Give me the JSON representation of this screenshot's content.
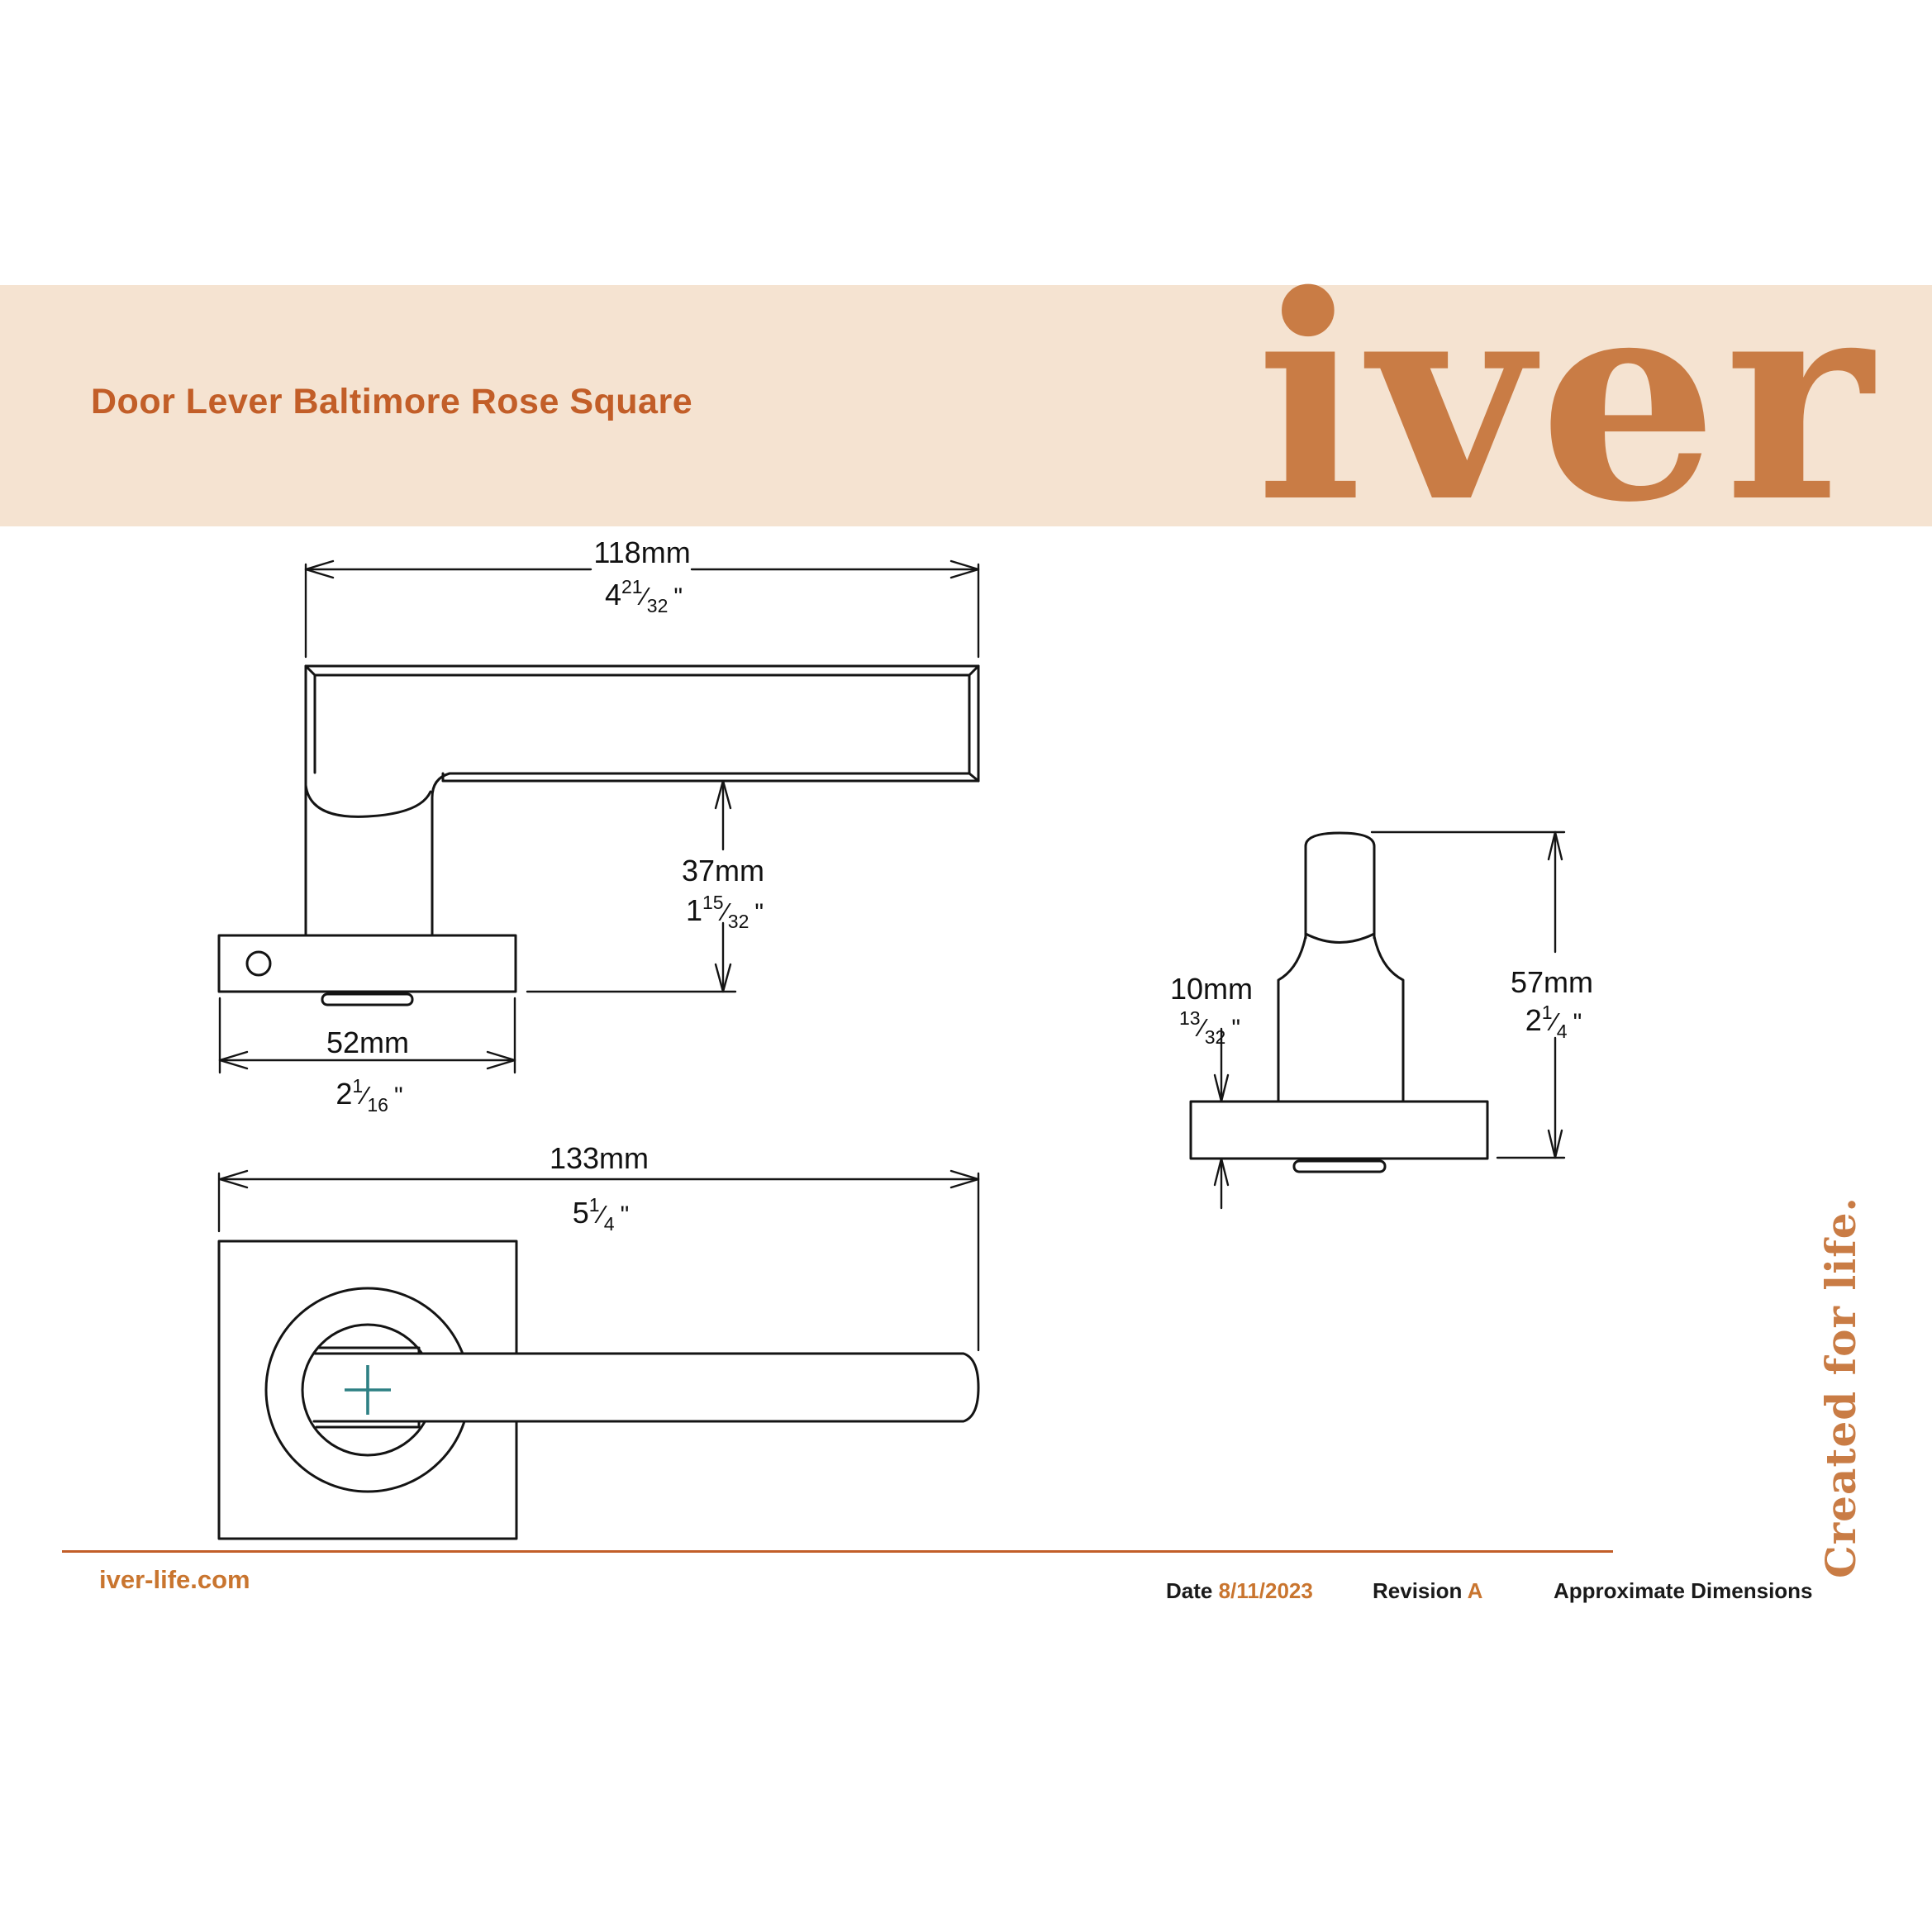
{
  "header": {
    "title": "Door Lever Baltimore Rose Square",
    "logo": "iver"
  },
  "side_note": "Created for life.",
  "footer": {
    "website": "iver-life.com",
    "date_label": "Date",
    "date_value": "8/11/2023",
    "revision_label": "Revision",
    "revision_value": "A",
    "note": "Approximate Dimensions"
  },
  "symbols": {
    "frac_sep": "⁄",
    "inch_mark": "\"",
    "center_mark": "+"
  },
  "dimensions": {
    "lever_length": {
      "mm": "118mm",
      "inch_whole": "4",
      "frac_num": "21",
      "frac_den": "32"
    },
    "lever_height": {
      "mm": "37mm",
      "inch_whole": "1",
      "frac_num": "15",
      "frac_den": "32"
    },
    "rose_width": {
      "mm": "52mm",
      "inch_whole": "2",
      "frac_num": "1",
      "frac_den": "16"
    },
    "overall_length": {
      "mm": "133mm",
      "inch_whole": "5",
      "frac_num": "1",
      "frac_den": "4"
    },
    "rose_thickness": {
      "mm": "10mm",
      "inch_whole": "",
      "frac_num": "13",
      "frac_den": "32"
    },
    "end_height": {
      "mm": "57mm",
      "inch_whole": "2",
      "frac_num": "1",
      "frac_den": "4"
    }
  },
  "colors": {
    "band": "#F5E3D1",
    "accent_orange": "#C25E28",
    "logo_orange": "#C97C45",
    "footer_value_orange": "#C9752F",
    "teal_center_mark": "#2E8084",
    "line": "#141414"
  }
}
